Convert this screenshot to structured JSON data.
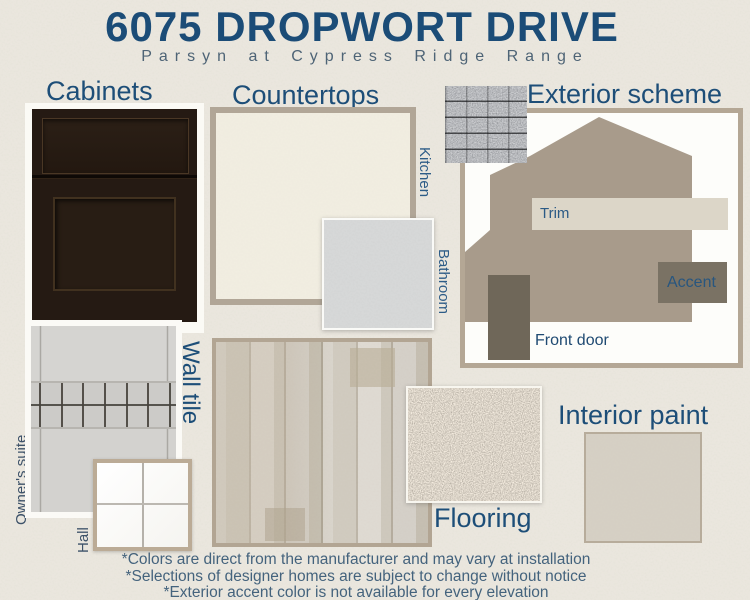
{
  "header": {
    "title": "6075 DROPWORT DRIVE",
    "subtitle": "Parsyn at Cypress Ridge Range"
  },
  "cabinets": {
    "heading": "Cabinets"
  },
  "countertops": {
    "heading": "Countertops",
    "kitchen_label": "Kitchen",
    "bathroom_label": "Bathroom"
  },
  "exterior": {
    "heading": "Exterior scheme",
    "trim_label": "Trim",
    "accent_label": "Accent",
    "front_door_label": "Front door"
  },
  "wall_tile": {
    "heading": "Wall tile",
    "owners_suite_label": "Owner's suite",
    "hall_label": "Hall"
  },
  "flooring": {
    "heading": "Flooring"
  },
  "interior_paint": {
    "heading": "Interior paint"
  },
  "footnotes": [
    "*Colors are direct from the manufacturer and may vary at installation",
    "*Selections of designer homes are subject to change without notice",
    "*Exterior accent color is not available for every elevation"
  ],
  "colors": {
    "background": "#ece8df",
    "heading_blue": "#1d4e78",
    "side_label_blue": "#2d5c87",
    "dark_label": "#3d5269",
    "footnote_blue": "#44637d",
    "swatch_border_tan": "#b3a795",
    "cabinet_espresso": "#251a13",
    "kitchen_counter_cream": "#f2eee1",
    "bathroom_counter_gray": "#d4d6d7",
    "shingle_gray": "#55585c",
    "house_body_taupe": "#a89b8b",
    "trim_cream": "#dcd6c8",
    "accent_taupe": "#7a7264",
    "front_door_brown": "#6f6759",
    "wall_tile_gray": "#d2d1ce",
    "hall_tile_white": "#fcfcf9",
    "flooring_greige": "#ccc6ba",
    "carpet_tan": "#c8bdac",
    "interior_paint_greige": "#d5cfc3"
  }
}
